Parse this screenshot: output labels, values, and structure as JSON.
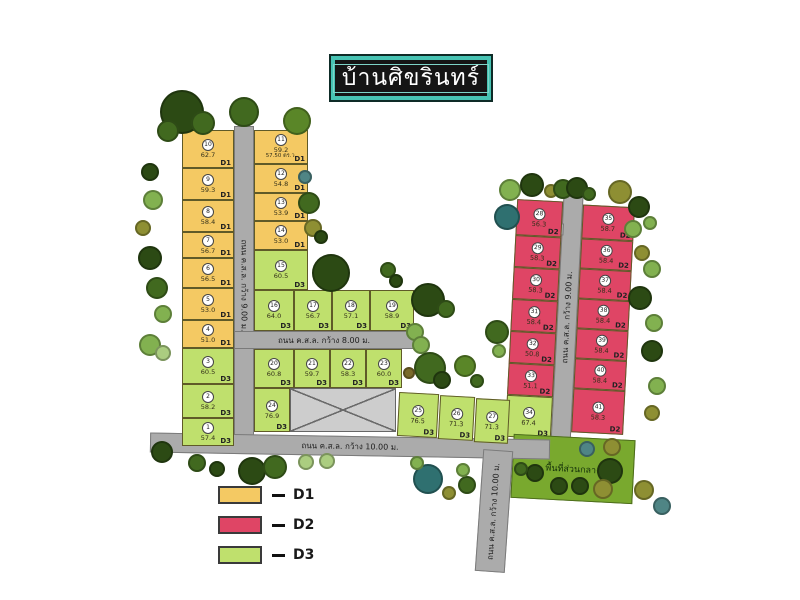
{
  "title": "บ้านศิขรินทร์",
  "common_area_label": "พื้นที่ส่วนกลาง",
  "legend": {
    "items": [
      {
        "label": "D1",
        "color": "#F4C963"
      },
      {
        "label": "D2",
        "color": "#DF4565"
      },
      {
        "label": "D3",
        "color": "#BFE06D"
      }
    ]
  },
  "colors": {
    "d1": "#F4C963",
    "d2": "#DF4565",
    "d3": "#BFE06D",
    "road": "#ABABAB",
    "common": "#79A92E",
    "title_frame": "#47C3B3",
    "trees": {
      "dark": "#2C4A14",
      "forest": "#41691F",
      "medium": "#5A8628",
      "light": "#82B150",
      "pale": "#ABCD80",
      "olive": "#8E8F33",
      "teal": "#4F8585",
      "darkteal": "#2F7070",
      "brown": "#7A6A2A"
    }
  },
  "roads": [
    {
      "id": "road-left-vertical",
      "label": "ถนน ค.ส.ล. กว้าง 9.00 ม.",
      "parent": "main",
      "x": 234,
      "y": 126,
      "w": 20,
      "h": 318,
      "rot": 0,
      "labelRot": 90
    },
    {
      "id": "road-mid-8m",
      "label": "ถนน ค.ส.ล. กว้าง 8.00 ม.",
      "parent": "main",
      "x": 234,
      "y": 331,
      "w": 180,
      "h": 18,
      "rot": 0,
      "labelRot": 0
    },
    {
      "id": "road-bottom-10m",
      "label": "ถนน ค.ส.ล. กว้าง 10.00 ม.",
      "parent": "main",
      "x": 150,
      "y": 436,
      "w": 400,
      "h": 20,
      "rot": 1,
      "labelRot": 0
    },
    {
      "id": "road-south-vertical",
      "label": "ถนน ค.ส.ล. กว้าง 10.00 ม.",
      "parent": "main",
      "x": 479,
      "y": 450,
      "w": 30,
      "h": 122,
      "rot": 4,
      "labelRot": -90
    },
    {
      "id": "road-red-vertical",
      "label": "ถนน ค.ส.ล. กว้าง 9.00 ม.",
      "parent": "red",
      "x": 52,
      "y": -6,
      "w": 20,
      "h": 258,
      "rot": 0,
      "labelRot": -90
    }
  ],
  "plots": [
    {
      "no": "10",
      "area": "62.7",
      "zone": "D1",
      "parent": "main",
      "x": 182,
      "y": 130,
      "w": 52,
      "h": 38
    },
    {
      "no": "9",
      "area": "59.3",
      "zone": "D1",
      "parent": "main",
      "x": 182,
      "y": 168,
      "w": 52,
      "h": 32
    },
    {
      "no": "8",
      "area": "58.4",
      "zone": "D1",
      "parent": "main",
      "x": 182,
      "y": 200,
      "w": 52,
      "h": 32
    },
    {
      "no": "7",
      "area": "56.7",
      "zone": "D1",
      "parent": "main",
      "x": 182,
      "y": 232,
      "w": 52,
      "h": 26
    },
    {
      "no": "6",
      "area": "56.5",
      "zone": "D1",
      "parent": "main",
      "x": 182,
      "y": 258,
      "w": 52,
      "h": 30
    },
    {
      "no": "5",
      "area": "53.0",
      "zone": "D1",
      "parent": "main",
      "x": 182,
      "y": 288,
      "w": 52,
      "h": 32
    },
    {
      "no": "4",
      "area": "51.0",
      "zone": "D1",
      "parent": "main",
      "x": 182,
      "y": 320,
      "w": 52,
      "h": 28
    },
    {
      "no": "3",
      "area": "60.5",
      "zone": "D3",
      "parent": "main",
      "x": 182,
      "y": 348,
      "w": 52,
      "h": 36
    },
    {
      "no": "2",
      "area": "58.2",
      "zone": "D3",
      "parent": "main",
      "x": 182,
      "y": 384,
      "w": 52,
      "h": 34
    },
    {
      "no": "1",
      "area": "57.4",
      "zone": "D3",
      "parent": "main",
      "x": 182,
      "y": 418,
      "w": 52,
      "h": 28
    },
    {
      "no": "11",
      "area": "59.2",
      "area2": "57.50 ตร.ว.",
      "zone": "D1",
      "parent": "main",
      "x": 254,
      "y": 130,
      "w": 54,
      "h": 34
    },
    {
      "no": "12",
      "area": "54.8",
      "zone": "D1",
      "parent": "main",
      "x": 254,
      "y": 164,
      "w": 54,
      "h": 29
    },
    {
      "no": "13",
      "area": "53.9",
      "zone": "D1",
      "parent": "main",
      "x": 254,
      "y": 193,
      "w": 54,
      "h": 28
    },
    {
      "no": "14",
      "area": "53.0",
      "zone": "D1",
      "parent": "main",
      "x": 254,
      "y": 221,
      "w": 54,
      "h": 29
    },
    {
      "no": "15",
      "area": "60.5",
      "zone": "D3",
      "parent": "main",
      "x": 254,
      "y": 250,
      "w": 54,
      "h": 40
    },
    {
      "no": "16",
      "area": "64.0",
      "zone": "D3",
      "parent": "main",
      "x": 254,
      "y": 290,
      "w": 40,
      "h": 41
    },
    {
      "no": "17",
      "area": "56.7",
      "zone": "D3",
      "parent": "main",
      "x": 294,
      "y": 290,
      "w": 38,
      "h": 41
    },
    {
      "no": "18",
      "area": "57.1",
      "zone": "D3",
      "parent": "main",
      "x": 332,
      "y": 290,
      "w": 38,
      "h": 41
    },
    {
      "no": "19",
      "area": "58.9",
      "zone": "D3",
      "parent": "main",
      "x": 370,
      "y": 290,
      "w": 44,
      "h": 41
    },
    {
      "no": "20",
      "area": "60.8",
      "zone": "D3",
      "parent": "main",
      "x": 254,
      "y": 349,
      "w": 40,
      "h": 39
    },
    {
      "no": "21",
      "area": "59.7",
      "zone": "D3",
      "parent": "main",
      "x": 294,
      "y": 349,
      "w": 36,
      "h": 39
    },
    {
      "no": "22",
      "area": "58.3",
      "zone": "D3",
      "parent": "main",
      "x": 330,
      "y": 349,
      "w": 36,
      "h": 39
    },
    {
      "no": "23",
      "area": "60.0",
      "zone": "D3",
      "parent": "main",
      "x": 366,
      "y": 349,
      "w": 36,
      "h": 39
    },
    {
      "no": "24",
      "area": "76.9",
      "zone": "D3",
      "parent": "main",
      "x": 254,
      "y": 388,
      "w": 36,
      "h": 44
    },
    {
      "no": "25",
      "area": "76.5",
      "zone": "D3",
      "parent": "main",
      "x": 398,
      "y": 393,
      "w": 40,
      "h": 44,
      "rot": 3
    },
    {
      "no": "26",
      "area": "71.3",
      "zone": "D3",
      "parent": "main",
      "x": 439,
      "y": 396,
      "w": 35,
      "h": 44,
      "rot": 3
    },
    {
      "no": "27",
      "area": "71.3",
      "zone": "D3",
      "parent": "main",
      "x": 475,
      "y": 399,
      "w": 34,
      "h": 44,
      "rot": 3
    },
    {
      "no": "28",
      "area": "56.3",
      "zone": "D2",
      "parent": "red",
      "x": 6,
      "y": 8,
      "w": 46,
      "h": 36
    },
    {
      "no": "29",
      "area": "58.3",
      "zone": "D2",
      "parent": "red",
      "x": 6,
      "y": 44,
      "w": 46,
      "h": 32
    },
    {
      "no": "30",
      "area": "58.3",
      "zone": "D2",
      "parent": "red",
      "x": 6,
      "y": 76,
      "w": 46,
      "h": 32
    },
    {
      "no": "31",
      "area": "58.4",
      "zone": "D2",
      "parent": "red",
      "x": 6,
      "y": 108,
      "w": 46,
      "h": 32
    },
    {
      "no": "32",
      "area": "50.8",
      "zone": "D2",
      "parent": "red",
      "x": 6,
      "y": 140,
      "w": 46,
      "h": 32
    },
    {
      "no": "33",
      "area": "51.1",
      "zone": "D2",
      "parent": "red",
      "x": 6,
      "y": 172,
      "w": 46,
      "h": 32
    },
    {
      "no": "34",
      "area": "67.4",
      "zone": "D3",
      "parent": "red",
      "x": 6,
      "y": 204,
      "w": 46,
      "h": 42
    },
    {
      "no": "35",
      "area": "58.7",
      "zone": "D2",
      "parent": "red",
      "x": 72,
      "y": 10,
      "w": 52,
      "h": 34
    },
    {
      "no": "36",
      "area": "58.4",
      "zone": "D2",
      "parent": "red",
      "x": 72,
      "y": 44,
      "w": 52,
      "h": 30
    },
    {
      "no": "37",
      "area": "58.4",
      "zone": "D2",
      "parent": "red",
      "x": 72,
      "y": 74,
      "w": 52,
      "h": 30
    },
    {
      "no": "38",
      "area": "58.4",
      "zone": "D2",
      "parent": "red",
      "x": 72,
      "y": 104,
      "w": 52,
      "h": 30
    },
    {
      "no": "39",
      "area": "58.4",
      "zone": "D2",
      "parent": "red",
      "x": 72,
      "y": 134,
      "w": 52,
      "h": 30
    },
    {
      "no": "40",
      "area": "58.4",
      "zone": "D2",
      "parent": "red",
      "x": 72,
      "y": 164,
      "w": 52,
      "h": 30
    },
    {
      "no": "41",
      "area": "58.3",
      "zone": "D2",
      "parent": "red",
      "x": 72,
      "y": 194,
      "w": 52,
      "h": 44
    }
  ],
  "trees": [
    {
      "x": 182,
      "y": 112,
      "r": 22,
      "c": "dark"
    },
    {
      "x": 203,
      "y": 123,
      "r": 12,
      "c": "forest"
    },
    {
      "x": 168,
      "y": 131,
      "r": 11,
      "c": "forest"
    },
    {
      "x": 244,
      "y": 112,
      "r": 15,
      "c": "forest"
    },
    {
      "x": 297,
      "y": 121,
      "r": 14,
      "c": "medium"
    },
    {
      "x": 150,
      "y": 172,
      "r": 9,
      "c": "dark"
    },
    {
      "x": 153,
      "y": 200,
      "r": 10,
      "c": "light"
    },
    {
      "x": 143,
      "y": 228,
      "r": 8,
      "c": "olive"
    },
    {
      "x": 150,
      "y": 258,
      "r": 12,
      "c": "dark"
    },
    {
      "x": 157,
      "y": 288,
      "r": 11,
      "c": "forest"
    },
    {
      "x": 163,
      "y": 314,
      "r": 9,
      "c": "light"
    },
    {
      "x": 150,
      "y": 345,
      "r": 11,
      "c": "light"
    },
    {
      "x": 163,
      "y": 353,
      "r": 8,
      "c": "pale"
    },
    {
      "x": 305,
      "y": 177,
      "r": 7,
      "c": "teal"
    },
    {
      "x": 309,
      "y": 203,
      "r": 11,
      "c": "forest"
    },
    {
      "x": 313,
      "y": 228,
      "r": 9,
      "c": "olive"
    },
    {
      "x": 321,
      "y": 237,
      "r": 7,
      "c": "dark"
    },
    {
      "x": 331,
      "y": 273,
      "r": 19,
      "c": "dark"
    },
    {
      "x": 388,
      "y": 270,
      "r": 8,
      "c": "forest"
    },
    {
      "x": 396,
      "y": 281,
      "r": 7,
      "c": "dark"
    },
    {
      "x": 428,
      "y": 300,
      "r": 17,
      "c": "dark"
    },
    {
      "x": 446,
      "y": 309,
      "r": 9,
      "c": "forest"
    },
    {
      "x": 415,
      "y": 332,
      "r": 9,
      "c": "light"
    },
    {
      "x": 421,
      "y": 345,
      "r": 9,
      "c": "light"
    },
    {
      "x": 430,
      "y": 368,
      "r": 16,
      "c": "forest"
    },
    {
      "x": 409,
      "y": 373,
      "r": 6,
      "c": "brown"
    },
    {
      "x": 442,
      "y": 380,
      "r": 9,
      "c": "dark"
    },
    {
      "x": 465,
      "y": 366,
      "r": 11,
      "c": "medium"
    },
    {
      "x": 477,
      "y": 381,
      "r": 7,
      "c": "forest"
    },
    {
      "x": 497,
      "y": 332,
      "r": 12,
      "c": "forest"
    },
    {
      "x": 499,
      "y": 351,
      "r": 7,
      "c": "light"
    },
    {
      "x": 510,
      "y": 190,
      "r": 11,
      "c": "light"
    },
    {
      "x": 507,
      "y": 217,
      "r": 13,
      "c": "darkteal"
    },
    {
      "x": 532,
      "y": 185,
      "r": 12,
      "c": "dark"
    },
    {
      "x": 551,
      "y": 191,
      "r": 7,
      "c": "olive"
    },
    {
      "x": 563,
      "y": 189,
      "r": 10,
      "c": "forest"
    },
    {
      "x": 577,
      "y": 188,
      "r": 11,
      "c": "dark"
    },
    {
      "x": 589,
      "y": 194,
      "r": 7,
      "c": "forest"
    },
    {
      "x": 620,
      "y": 192,
      "r": 12,
      "c": "olive"
    },
    {
      "x": 639,
      "y": 207,
      "r": 11,
      "c": "dark"
    },
    {
      "x": 650,
      "y": 223,
      "r": 7,
      "c": "light"
    },
    {
      "x": 633,
      "y": 229,
      "r": 9,
      "c": "light"
    },
    {
      "x": 642,
      "y": 253,
      "r": 8,
      "c": "olive"
    },
    {
      "x": 652,
      "y": 269,
      "r": 9,
      "c": "light"
    },
    {
      "x": 640,
      "y": 298,
      "r": 12,
      "c": "dark"
    },
    {
      "x": 654,
      "y": 323,
      "r": 9,
      "c": "light"
    },
    {
      "x": 652,
      "y": 351,
      "r": 11,
      "c": "dark"
    },
    {
      "x": 657,
      "y": 386,
      "r": 9,
      "c": "light"
    },
    {
      "x": 652,
      "y": 413,
      "r": 8,
      "c": "olive"
    },
    {
      "x": 610,
      "y": 471,
      "r": 13,
      "c": "dark"
    },
    {
      "x": 644,
      "y": 490,
      "r": 10,
      "c": "olive"
    },
    {
      "x": 662,
      "y": 506,
      "r": 9,
      "c": "teal"
    },
    {
      "x": 535,
      "y": 473,
      "r": 9,
      "c": "dark"
    },
    {
      "x": 559,
      "y": 486,
      "r": 9,
      "c": "dark"
    },
    {
      "x": 580,
      "y": 486,
      "r": 9,
      "c": "dark"
    },
    {
      "x": 603,
      "y": 489,
      "r": 10,
      "c": "olive"
    },
    {
      "x": 587,
      "y": 449,
      "r": 8,
      "c": "teal"
    },
    {
      "x": 612,
      "y": 447,
      "r": 9,
      "c": "olive"
    },
    {
      "x": 521,
      "y": 469,
      "r": 7,
      "c": "forest"
    },
    {
      "x": 162,
      "y": 452,
      "r": 11,
      "c": "dark"
    },
    {
      "x": 197,
      "y": 463,
      "r": 9,
      "c": "forest"
    },
    {
      "x": 217,
      "y": 469,
      "r": 8,
      "c": "dark"
    },
    {
      "x": 252,
      "y": 471,
      "r": 14,
      "c": "dark"
    },
    {
      "x": 275,
      "y": 467,
      "r": 12,
      "c": "forest"
    },
    {
      "x": 306,
      "y": 462,
      "r": 8,
      "c": "pale"
    },
    {
      "x": 327,
      "y": 461,
      "r": 8,
      "c": "pale"
    },
    {
      "x": 428,
      "y": 479,
      "r": 15,
      "c": "darkteal"
    },
    {
      "x": 449,
      "y": 493,
      "r": 7,
      "c": "olive"
    },
    {
      "x": 467,
      "y": 485,
      "r": 9,
      "c": "forest"
    },
    {
      "x": 463,
      "y": 470,
      "r": 7,
      "c": "light"
    },
    {
      "x": 417,
      "y": 463,
      "r": 7,
      "c": "light"
    }
  ]
}
